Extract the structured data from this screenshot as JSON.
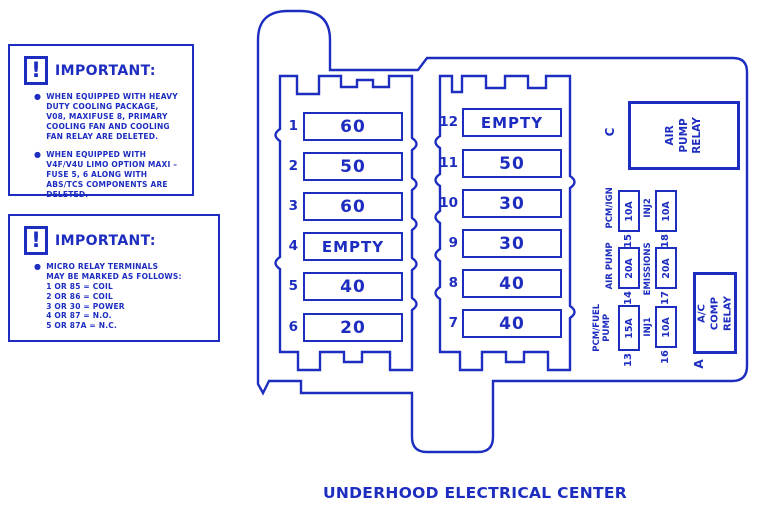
{
  "title": "UNDERHOOD ELECTRICAL CENTER",
  "colors": {
    "ink": "#1d2dc0",
    "background": "#ffffff"
  },
  "notes": [
    {
      "icon": "!",
      "header": "IMPORTANT:",
      "bullets": [
        "WHEN EQUIPPED WITH HEAVY\nDUTY COOLING PACKAGE,\nV08, MAXIFUSE 8, PRIMARY\nCOOLING FAN AND COOLING\nFAN RELAY ARE DELETED.",
        "WHEN EQUIPPED WITH\nV4F/V4U LIMO OPTION MAXI –\nFUSE 5, 6 ALONG WITH\nABS/TCS COMPONENTS ARE\nDELETED."
      ]
    },
    {
      "icon": "!",
      "header": "IMPORTANT:",
      "bullets": [
        "MICRO RELAY TERMINALS\nMAY BE MARKED AS FOLLOWS:\n1 OR 85 = COIL\n2 OR 86 = COIL\n3 OR 30 = POWER\n4 OR 87 = N.O.\n5 OR 87A = N.C."
      ]
    }
  ],
  "maxi_fuses": {
    "left": [
      {
        "num": "1",
        "value": "60"
      },
      {
        "num": "2",
        "value": "50"
      },
      {
        "num": "3",
        "value": "60"
      },
      {
        "num": "4",
        "value": "EMPTY"
      },
      {
        "num": "5",
        "value": "40"
      },
      {
        "num": "6",
        "value": "20"
      }
    ],
    "right": [
      {
        "num": "12",
        "value": "EMPTY"
      },
      {
        "num": "11",
        "value": "50"
      },
      {
        "num": "10",
        "value": "30"
      },
      {
        "num": "9",
        "value": "30"
      },
      {
        "num": "8",
        "value": "40"
      },
      {
        "num": "7",
        "value": "40"
      }
    ]
  },
  "mini_fuses": {
    "f15": {
      "num": "15",
      "label": "PCM/IGN",
      "value": "10A"
    },
    "f14": {
      "num": "14",
      "label": "AIR PUMP",
      "value": "20A"
    },
    "f13": {
      "num": "13",
      "label": "PCM/FUEL\nPUMP",
      "value": "15A"
    },
    "f18": {
      "num": "18",
      "label": "INJ2",
      "value": "10A"
    },
    "f17": {
      "num": "17",
      "label": "EMISSIONS",
      "value": "20A"
    },
    "f16": {
      "num": "16",
      "label": "INJ1",
      "value": "10A"
    }
  },
  "relays": {
    "air_pump": {
      "slot": "C",
      "label": "AIR\nPUMP\nRELAY"
    },
    "ac_comp": {
      "slot": "A",
      "label": "A/C COMP\nRELAY"
    }
  }
}
